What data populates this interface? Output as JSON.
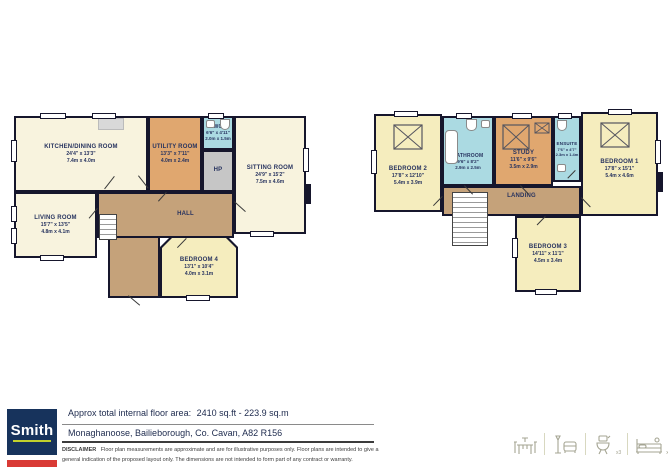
{
  "palette": {
    "wall": "#16162c",
    "cream": "#f8f3de",
    "yellow": "#f5edbe",
    "orange": "#e0a76f",
    "brown": "#c5a27a",
    "blue": "#abdae2",
    "gray": "#c6c6c6",
    "logo_navy": "#17335c",
    "logo_red": "#d93a35",
    "logo_lime": "#c2d12c",
    "icon_olive": "#a5a593"
  },
  "ground_floor": {
    "rooms": {
      "kitchen": {
        "name": "KITCHEN/DINING ROOM",
        "ft": "24'4\" x 13'3\"",
        "m": "7.4m x 4.0m"
      },
      "living": {
        "name": "LIVING ROOM",
        "ft": "15'7\" x 13'5\"",
        "m": "4.8m x 4.1m"
      },
      "utility": {
        "name": "UTILITY ROOM",
        "ft": "13'3\" x 7'11\"",
        "m": "4.0m x 2.4m"
      },
      "wc": {
        "name": "WC",
        "ft": "6'6\" x 4'11\"",
        "m": "2.0m x 1.5m"
      },
      "hp": {
        "name": "HP"
      },
      "sitting": {
        "name": "SITTING ROOM",
        "ft": "24'9\" x 15'2\"",
        "m": "7.5m x 4.6m"
      },
      "hall": {
        "name": "HALL"
      },
      "bedroom4": {
        "name": "BEDROOM 4",
        "ft": "13'1\" x 10'4\"",
        "m": "4.0m x 3.1m"
      }
    }
  },
  "first_floor": {
    "rooms": {
      "bedroom2": {
        "name": "BEDROOM 2",
        "ft": "17'8\" x 12'10\"",
        "m": "5.4m x 3.9m"
      },
      "bathroom": {
        "name": "BATHROOM",
        "ft": "9'6\" x 8'2\"",
        "m": "2.9m x 2.5m"
      },
      "study": {
        "name": "STUDY",
        "ft": "11'6\" x 9'6\"",
        "m": "3.5m x 2.9m"
      },
      "ensuite": {
        "name": "ENSUITE",
        "ft": "7'6\" x 4'7\"",
        "m": "2.3m x 1.4m"
      },
      "bedroom1": {
        "name": "BEDROOM 1",
        "ft": "17'8\" x 15'1\"",
        "m": "5.4m x 4.6m"
      },
      "landing": {
        "name": "LANDING"
      },
      "bedroom3": {
        "name": "BEDROOM 3",
        "ft": "14'11\" x 11'1\"",
        "m": "4.5m x 3.4m"
      }
    }
  },
  "footer": {
    "area_label": "Approx total internal floor area:",
    "area_value": "2410 sq.ft - 223.9 sq.m",
    "address": "Monaghanoose, Bailieborough, Co. Cavan, A82 R156",
    "disclaimer_label": "DISCLAIMER",
    "disclaimer_text": "Floor plan measurements are approximate and are for illustrative purposes only.  Floor plans are intended to give a general indication of the proposed layout only. The dimensions are not intended to form part of any contract or warranty.",
    "logo_text": "Smith",
    "counts": {
      "bathrooms": "x3",
      "bedrooms": "x4"
    }
  }
}
